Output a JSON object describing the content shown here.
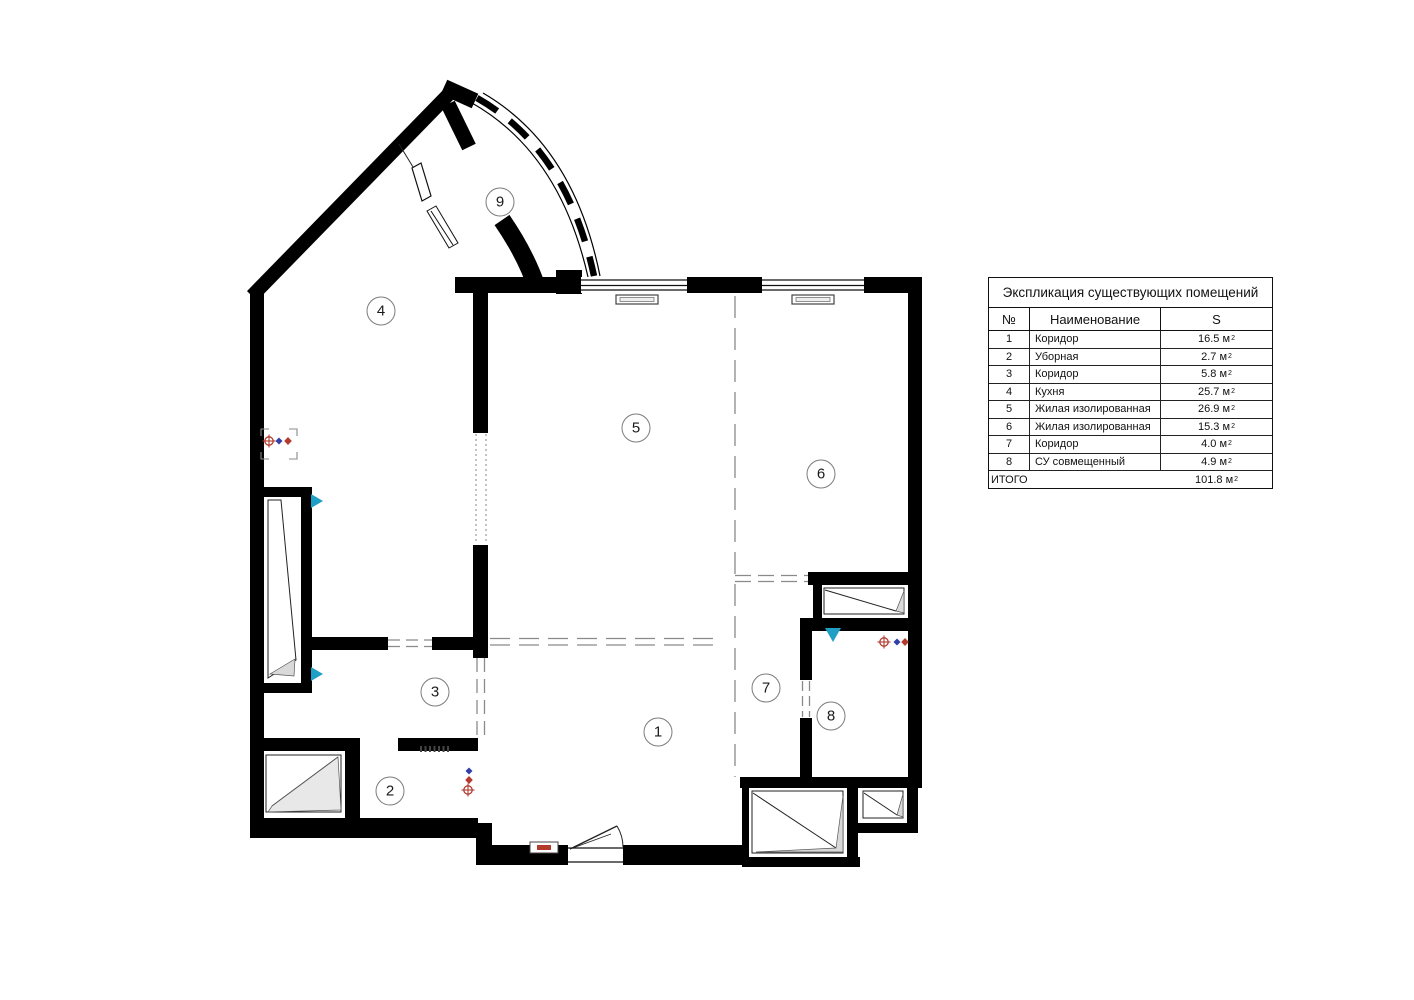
{
  "plan": {
    "rooms": [
      {
        "n": "1"
      },
      {
        "n": "2"
      },
      {
        "n": "3"
      },
      {
        "n": "4"
      },
      {
        "n": "5"
      },
      {
        "n": "6"
      },
      {
        "n": "7"
      },
      {
        "n": "8"
      },
      {
        "n": "9"
      }
    ]
  },
  "table": {
    "title": "Экспликация существующих помещений",
    "headers": {
      "num": "№",
      "name": "Наименование",
      "area": "S"
    },
    "unit": "м",
    "unit_sup": "2",
    "rows": [
      {
        "n": "1",
        "name": "Коридор",
        "area": "16.5"
      },
      {
        "n": "2",
        "name": "Уборная",
        "area": "2.7"
      },
      {
        "n": "3",
        "name": "Коридор",
        "area": "5.8"
      },
      {
        "n": "4",
        "name": "Кухня",
        "area": "25.7"
      },
      {
        "n": "5",
        "name": "Жилая изолированная",
        "area": "26.9"
      },
      {
        "n": "6",
        "name": "Жилая изолированная",
        "area": "15.3"
      },
      {
        "n": "7",
        "name": "Коридор",
        "area": "4.0"
      },
      {
        "n": "8",
        "name": "СУ совмещенный",
        "area": "4.9"
      }
    ],
    "total_label": "ИТОГО",
    "total_area": "101.8"
  },
  "colors": {
    "wall": "#000000",
    "dash": "#8a8a8a",
    "accent_red": "#b23b2e",
    "accent_blue": "#3040a8",
    "accent_teal": "#1f9fc6",
    "leaf_shade": "#d9d9d9"
  }
}
